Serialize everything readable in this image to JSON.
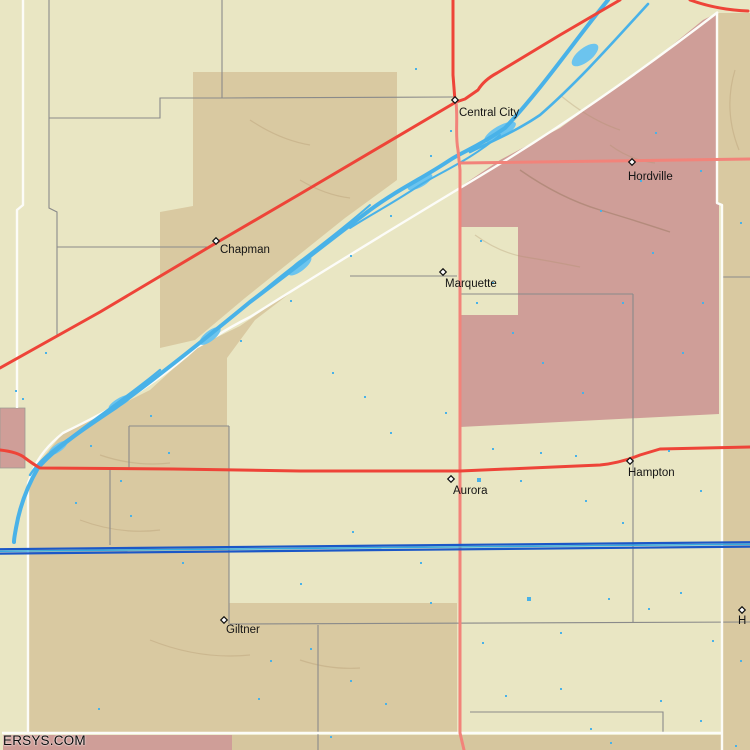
{
  "map": {
    "watermark": "ERSYS.COM",
    "towns": [
      {
        "name": "Central City"
      },
      {
        "name": "Hordville"
      },
      {
        "name": "Chapman"
      },
      {
        "name": "Marquette"
      },
      {
        "name": "Aurora"
      },
      {
        "name": "Hampton"
      },
      {
        "name": "Giltner"
      },
      {
        "name": "H"
      }
    ],
    "colors": {
      "background_cream": "#e9e6c3",
      "farmland_tan": "#d9c9a1",
      "county_pink": "#cf9e98",
      "highway_red": "#ee4438",
      "highway_red_light": "#f2837a",
      "road_gray": "#8a8a8a",
      "boundary_white": "#fcfcf8",
      "river_blue": "#49b2e8",
      "canal_blue_dark": "#1b57c7",
      "canal_blue_light": "#35aadf",
      "label_black": "#141414"
    },
    "water_speckles": [
      [
        415,
        68
      ],
      [
        477,
        478,
        4
      ],
      [
        130,
        515
      ],
      [
        182,
        562
      ],
      [
        352,
        531
      ],
      [
        300,
        583
      ],
      [
        420,
        562
      ],
      [
        98,
        708
      ],
      [
        258,
        698
      ],
      [
        385,
        703
      ],
      [
        527,
        597,
        4
      ],
      [
        560,
        688
      ],
      [
        610,
        742
      ],
      [
        660,
        700
      ],
      [
        700,
        720
      ],
      [
        735,
        745
      ],
      [
        120,
        480
      ],
      [
        75,
        502
      ],
      [
        168,
        452
      ],
      [
        520,
        480
      ],
      [
        585,
        500
      ],
      [
        622,
        522
      ],
      [
        700,
        490
      ],
      [
        480,
        240
      ],
      [
        492,
        282
      ],
      [
        476,
        302
      ],
      [
        512,
        332
      ],
      [
        542,
        362
      ],
      [
        582,
        392
      ],
      [
        622,
        302
      ],
      [
        652,
        252
      ],
      [
        682,
        352
      ],
      [
        702,
        302
      ],
      [
        640,
        180
      ],
      [
        700,
        170
      ],
      [
        740,
        222
      ],
      [
        364,
        396
      ],
      [
        390,
        432
      ],
      [
        332,
        372
      ],
      [
        45,
        352
      ],
      [
        15,
        390
      ],
      [
        22,
        398
      ],
      [
        445,
        412
      ],
      [
        492,
        448
      ],
      [
        540,
        452
      ],
      [
        575,
        455
      ],
      [
        608,
        598
      ],
      [
        648,
        608
      ],
      [
        680,
        592
      ],
      [
        712,
        640
      ],
      [
        740,
        660
      ],
      [
        560,
        632
      ],
      [
        482,
        642
      ],
      [
        430,
        602
      ],
      [
        505,
        695
      ],
      [
        310,
        648
      ],
      [
        270,
        660
      ],
      [
        350,
        680
      ],
      [
        450,
        130
      ],
      [
        430,
        155
      ],
      [
        390,
        215
      ],
      [
        350,
        255
      ],
      [
        290,
        300
      ],
      [
        240,
        340
      ],
      [
        150,
        415
      ],
      [
        90,
        445
      ],
      [
        655,
        132
      ],
      [
        600,
        210
      ],
      [
        668,
        450
      ],
      [
        330,
        736
      ],
      [
        590,
        728
      ]
    ]
  }
}
